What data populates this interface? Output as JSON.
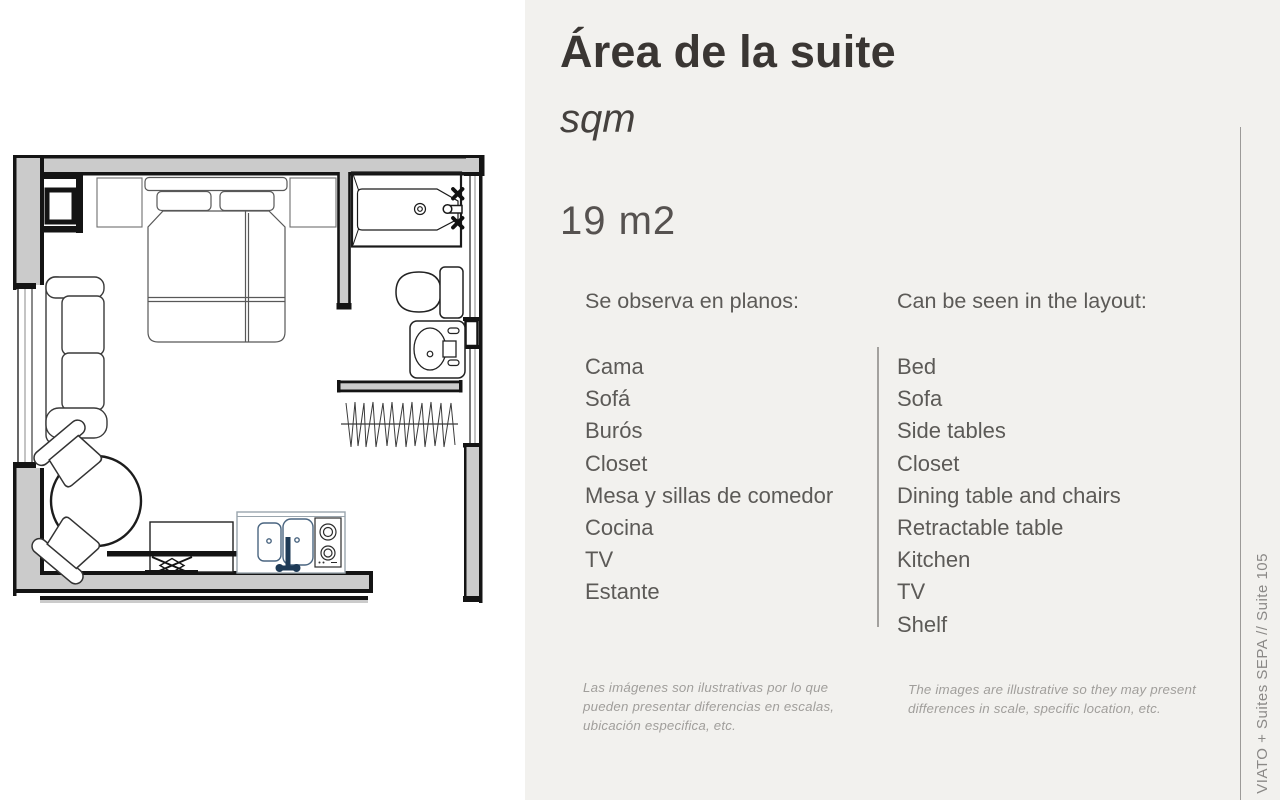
{
  "panel": {
    "title": "Área de la suite",
    "subtitle": "sqm",
    "area_value": "19 m2",
    "columns": {
      "spanish": {
        "header": "Se observa en planos:",
        "items": [
          "Cama",
          "Sofá",
          "Burós",
          "Closet",
          "Mesa y sillas de comedor",
          "Cocina",
          "TV",
          "Estante"
        ],
        "disclaimer": "Las imágenes son ilustrativas por lo que pueden presentar diferencias en escalas, ubicación especifica, etc."
      },
      "english": {
        "header": "Can be seen in the layout:",
        "items": [
          "Bed",
          "Sofa",
          "Side tables",
          "Closet",
          "Dining table and chairs",
          "Retractable table",
          "Kitchen",
          "TV",
          "Shelf"
        ],
        "disclaimer": "The images are illustrative so they may present differences in scale, specific location, etc."
      }
    },
    "side_label": "VIATO + Suites SEPA // Suite 105"
  },
  "floorplan": {
    "fixtures": [
      "bed",
      "pillows",
      "headboard",
      "side-tables",
      "sofa",
      "round-dining-table",
      "dining-chairs",
      "tv",
      "shelf",
      "retractable-table",
      "kitchen-counter",
      "double-sink",
      "cooktop",
      "closet-hanging-rod",
      "bathtub",
      "tub-faucet",
      "toilet",
      "bathroom-sink",
      "windows",
      "walls",
      "entry-opening"
    ]
  },
  "colors": {
    "panel_background": "#f2f1ee",
    "plan_background": "#ffffff",
    "title_text": "#3a3633",
    "body_text": "#5c5a57",
    "muted_text": "#a09e9b",
    "divider": "#a3a19e",
    "wall_fill": "#cbcbcb",
    "wall_line": "#141414",
    "kitchen_accent": "#4a6580",
    "faucet_navy": "#1e3a56"
  }
}
